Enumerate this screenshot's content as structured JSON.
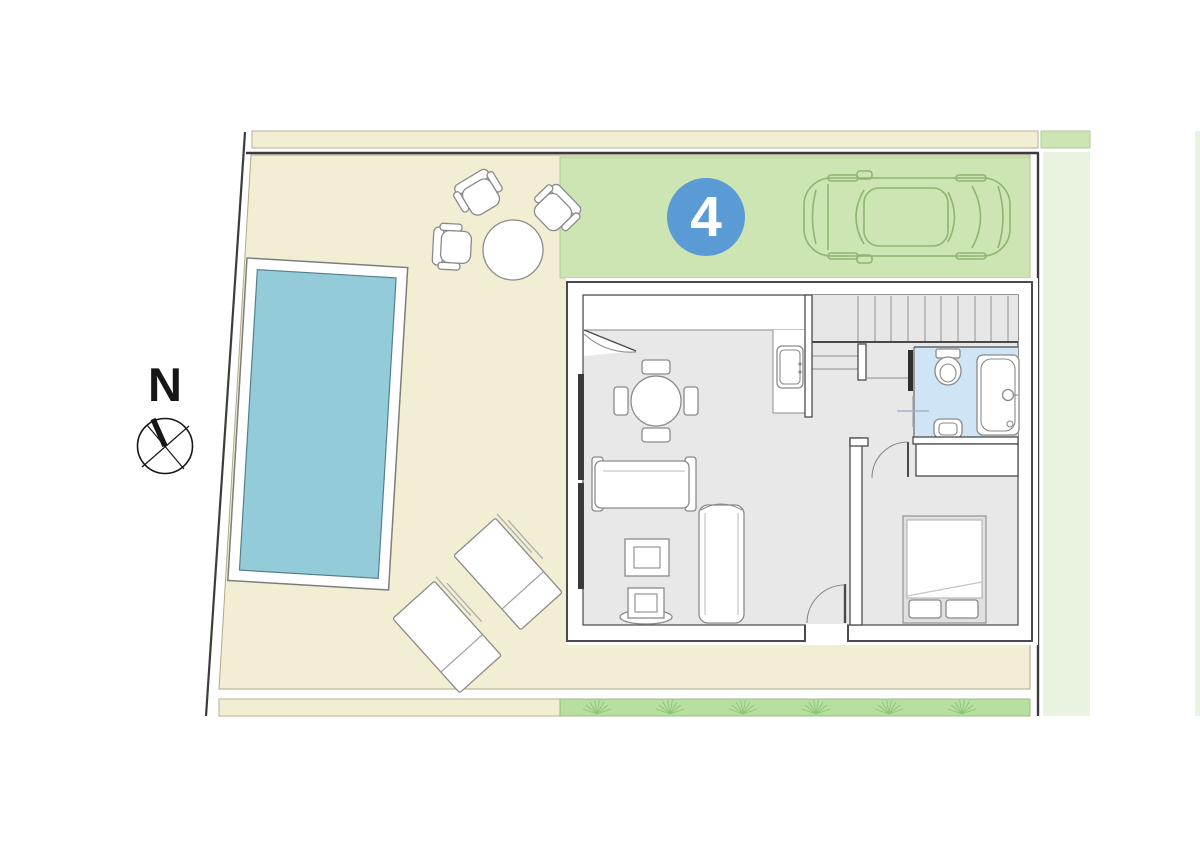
{
  "plan": {
    "unit_badge": "4",
    "compass_label": "N"
  },
  "colors": {
    "accent": "#5b9bd5",
    "badge_text": "#ffffff",
    "compass": "#161616",
    "pool_water": "#94cbd9",
    "pool_edge": "#54808d",
    "terrace": "#f2eed3",
    "terrace_border": "#aeaa8c",
    "driveway": "#cde5b2",
    "driveway_border": "#a9c98e",
    "lawn": "#b6dfa0",
    "lawn_border": "#95b57c",
    "outside_strip": "#e9f3e0",
    "bathroom_floor": "#cfe4f5",
    "floor": "#e8e8e8",
    "stair_fill": "#e6e6e6",
    "wall": "#4a4a4a",
    "furniture_line": "#8a8a8a",
    "car_line": "#8fb573",
    "grass_line": "#8cc479",
    "boundary": "#3c3c3c"
  }
}
